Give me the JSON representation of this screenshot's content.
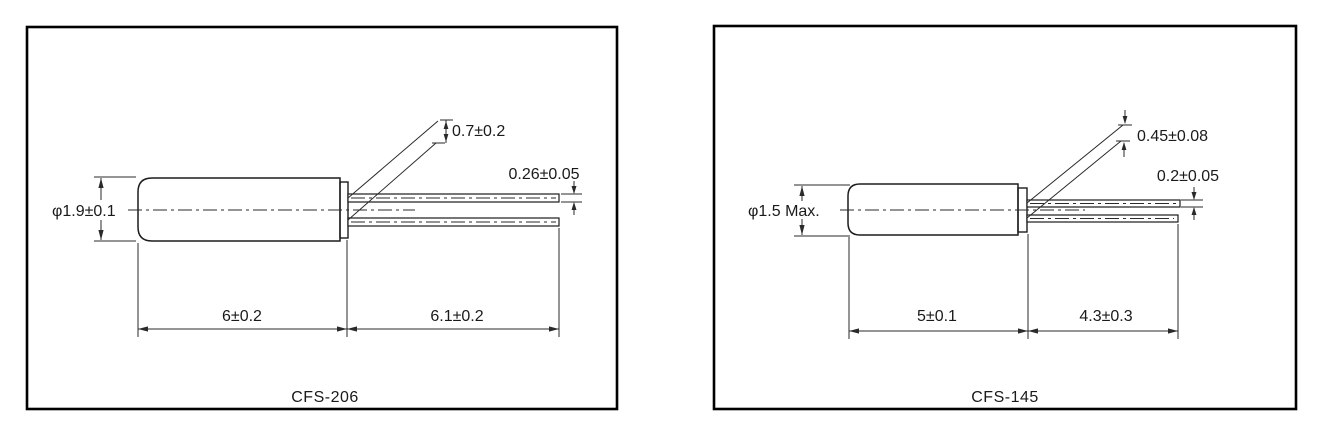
{
  "diagrams": [
    {
      "title": "CFS-206",
      "dimensions": {
        "diameter": "φ1.9±0.1",
        "lead_spacing": "0.7±0.2",
        "lead_thickness": "0.26±0.05",
        "body_length": "6±0.2",
        "lead_length": "6.1±0.2"
      }
    },
    {
      "title": "CFS-145",
      "dimensions": {
        "diameter": "φ1.5 Max.",
        "lead_spacing": "0.45±0.08",
        "lead_thickness": "0.2±0.05",
        "body_length": "5±0.1",
        "lead_length": "4.3±0.3"
      }
    }
  ],
  "colors": {
    "line": "#1c1c1c",
    "background": "#ffffff"
  }
}
